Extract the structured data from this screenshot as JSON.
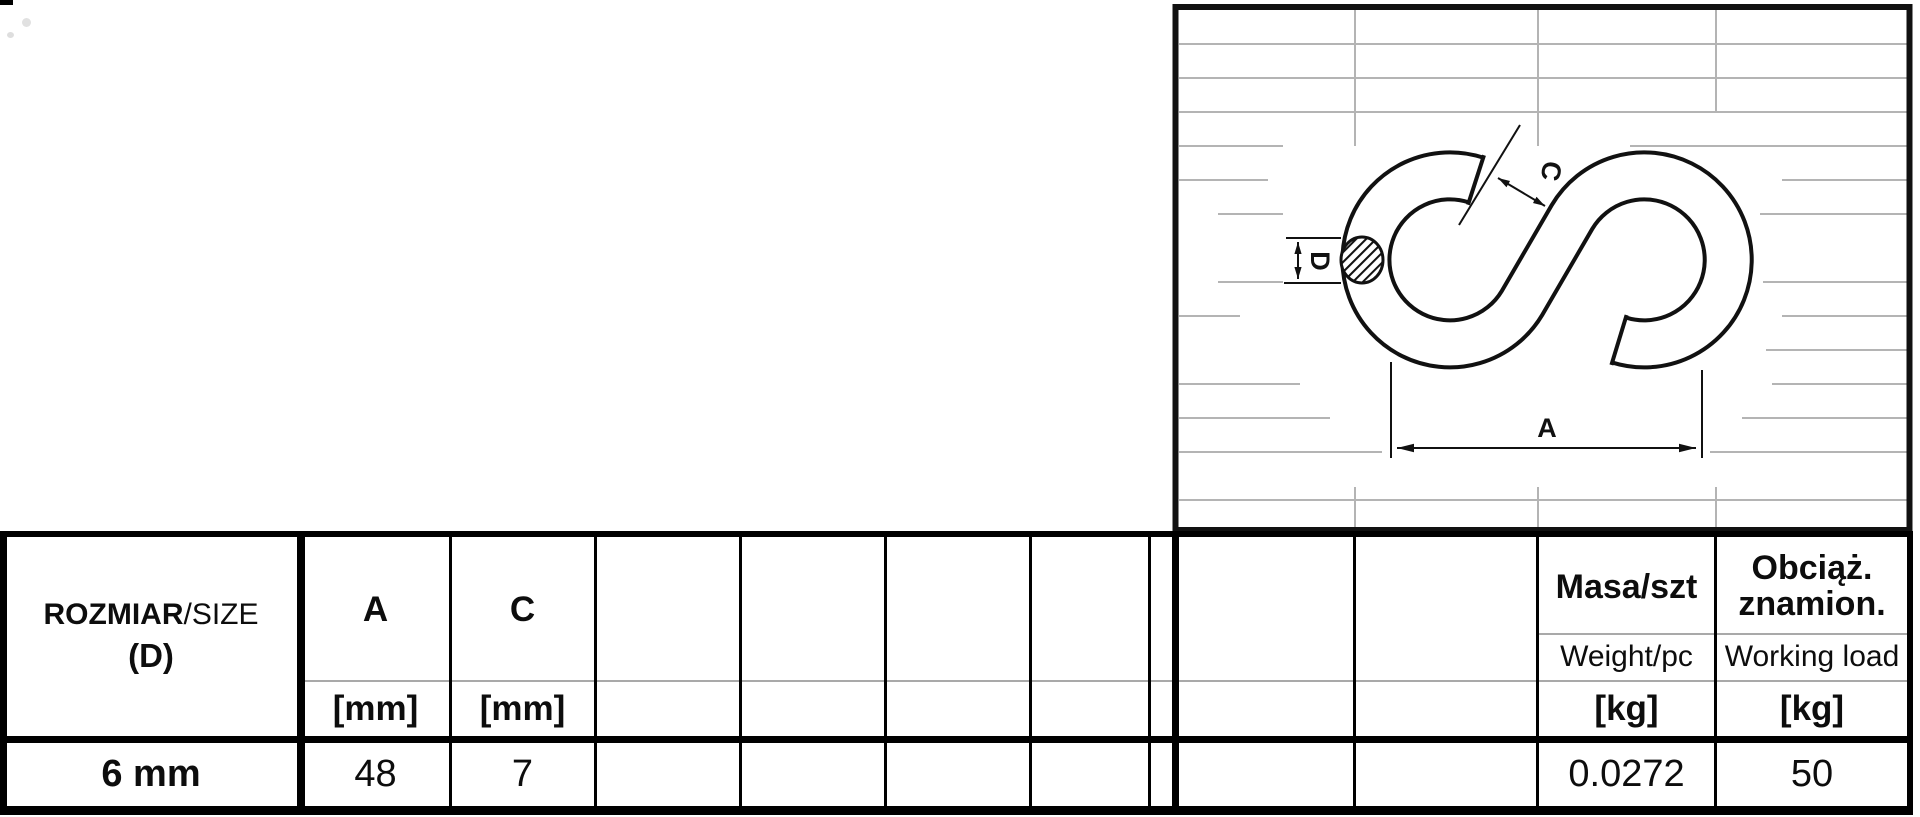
{
  "drawing": {
    "dim_a": "A",
    "dim_c": "C",
    "dim_d": "D"
  },
  "table": {
    "size_col": {
      "name_bold": "ROZMIAR",
      "name_regular": "/SIZE",
      "name_line2": "(D)"
    },
    "a_col": {
      "label": "A",
      "unit": "[mm]"
    },
    "c_col": {
      "label": "C",
      "unit": "[mm]"
    },
    "mass_col": {
      "label": "Masa/szt",
      "sub": "Weight/pc",
      "unit": "[kg]"
    },
    "load_col": {
      "label_line1": "Obciąż.",
      "label_line2": "znamion.",
      "sub": "Working load",
      "unit": "[kg]"
    },
    "data_row": {
      "size": "6 mm",
      "a": "48",
      "c": "7",
      "mass": "0.0272",
      "load": "50"
    }
  }
}
